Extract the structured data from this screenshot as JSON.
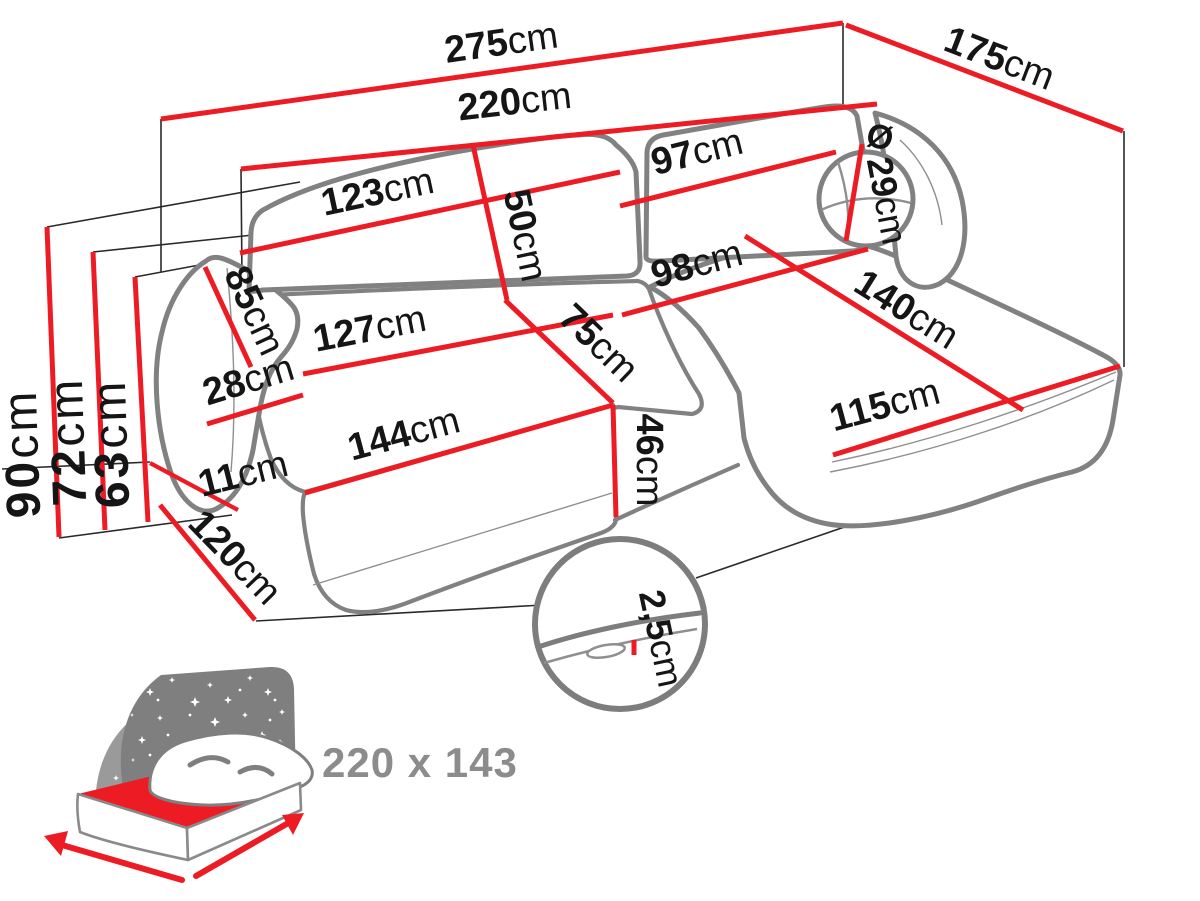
{
  "page": {
    "background": "#ffffff"
  },
  "colors": {
    "dimension_line": "#ed1c24",
    "sofa_outline": "#818181",
    "projection_line": "#2a2a2a",
    "label_text": "#151515",
    "muted_text": "#8c8c8c"
  },
  "unit_default": "cm",
  "dims": {
    "total_width": {
      "value": "275",
      "unit": "cm"
    },
    "total_depth": {
      "value": "175",
      "unit": "cm"
    },
    "seat_width": {
      "value": "220",
      "unit": "cm"
    },
    "backrest_left_width": {
      "value": "123",
      "unit": "cm"
    },
    "backrest_right_width": {
      "value": "97",
      "unit": "cm"
    },
    "backrest_height": {
      "value": "50",
      "unit": "cm"
    },
    "bolster_diameter": {
      "prefix": "Ø",
      "value": "29",
      "unit": "cm"
    },
    "armrest_length": {
      "value": "85",
      "unit": "cm"
    },
    "armrest_width": {
      "value": "28",
      "unit": "cm"
    },
    "chaise_width": {
      "value": "98",
      "unit": "cm"
    },
    "chaise_length": {
      "value": "140",
      "unit": "cm"
    },
    "chaise_front_length": {
      "value": "115",
      "unit": "cm"
    },
    "seat_cushion_width": {
      "value": "127",
      "unit": "cm"
    },
    "seat_depth": {
      "value": "75",
      "unit": "cm"
    },
    "seat_front_width": {
      "value": "144",
      "unit": "cm"
    },
    "seat_height": {
      "value": "46",
      "unit": "cm"
    },
    "base_height": {
      "value": "11",
      "unit": "cm"
    },
    "base_depth": {
      "value": "120",
      "unit": "cm"
    },
    "height_total": {
      "value": "90",
      "unit": "cm"
    },
    "height_armrest": {
      "value": "72",
      "unit": "cm"
    },
    "height_seat": {
      "value": "63",
      "unit": "cm"
    },
    "gap_detail": {
      "value": "2,5",
      "unit": "cm"
    }
  },
  "sleeping_area": {
    "label": "220 x 143"
  }
}
